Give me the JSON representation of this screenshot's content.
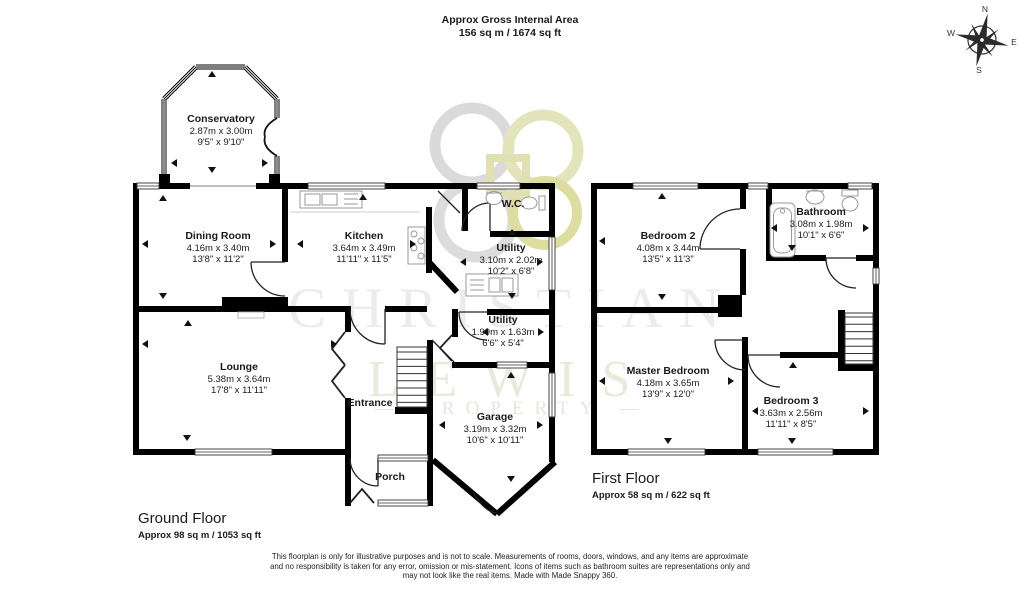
{
  "header": {
    "line1": "Approx Gross Internal Area",
    "line2": "156 sq m / 1674 sq ft"
  },
  "compass": {
    "n": "N",
    "e": "E",
    "s": "S",
    "w": "W"
  },
  "watermark": {
    "line1": "CHRISTIAN",
    "line2": "LEWIS",
    "line3": "— PROPERTY —"
  },
  "ground_floor": {
    "title": "Ground Floor",
    "area": "Approx 98 sq m / 1053 sq ft",
    "rooms": [
      {
        "name": "Conservatory",
        "metric": "2.87m x 3.00m",
        "imperial": "9'5\" x 9'10\""
      },
      {
        "name": "Dining Room",
        "metric": "4.16m x 3.40m",
        "imperial": "13'8\" x 11'2\""
      },
      {
        "name": "Kitchen",
        "metric": "3.64m x 3.49m",
        "imperial": "11'11\" x 11'5\""
      },
      {
        "name": "W.C."
      },
      {
        "name": "Utility",
        "metric": "3.10m x 2.02m",
        "imperial": "10'2\" x 6'8\""
      },
      {
        "name": "Lounge",
        "metric": "5.38m x 3.64m",
        "imperial": "17'8\" x 11'11\""
      },
      {
        "name": "Utility",
        "metric": "1.99m x 1.63m",
        "imperial": "6'6\" x 5'4\""
      },
      {
        "name": "Entrance"
      },
      {
        "name": "Garage",
        "metric": "3.19m x 3.32m",
        "imperial": "10'6\" x 10'11\""
      },
      {
        "name": "Porch"
      }
    ]
  },
  "first_floor": {
    "title": "First Floor",
    "area": "Approx 58 sq m / 622 sq ft",
    "rooms": [
      {
        "name": "Bedroom 2",
        "metric": "4.08m x 3.44m",
        "imperial": "13'5\" x 11'3\""
      },
      {
        "name": "Bathroom",
        "metric": "3.08m x 1.98m",
        "imperial": "10'1\" x 6'6\""
      },
      {
        "name": "Master Bedroom",
        "metric": "4.18m x 3.65m",
        "imperial": "13'9\" x 12'0\""
      },
      {
        "name": "Bedroom 3",
        "metric": "3.63m x 2.56m",
        "imperial": "11'11\" x 8'5\""
      }
    ]
  },
  "footer": {
    "line1": "This floorplan is only for illustrative purposes and is not to scale. Measurements of rooms, doors, windows, and any items are approximate",
    "line2": "and no responsibility is taken for any error, omission or mis-statement. Icons of items such as bathroom suites are representations only and",
    "line3": "may not look like the real items. Made with Made Snappy 360."
  }
}
